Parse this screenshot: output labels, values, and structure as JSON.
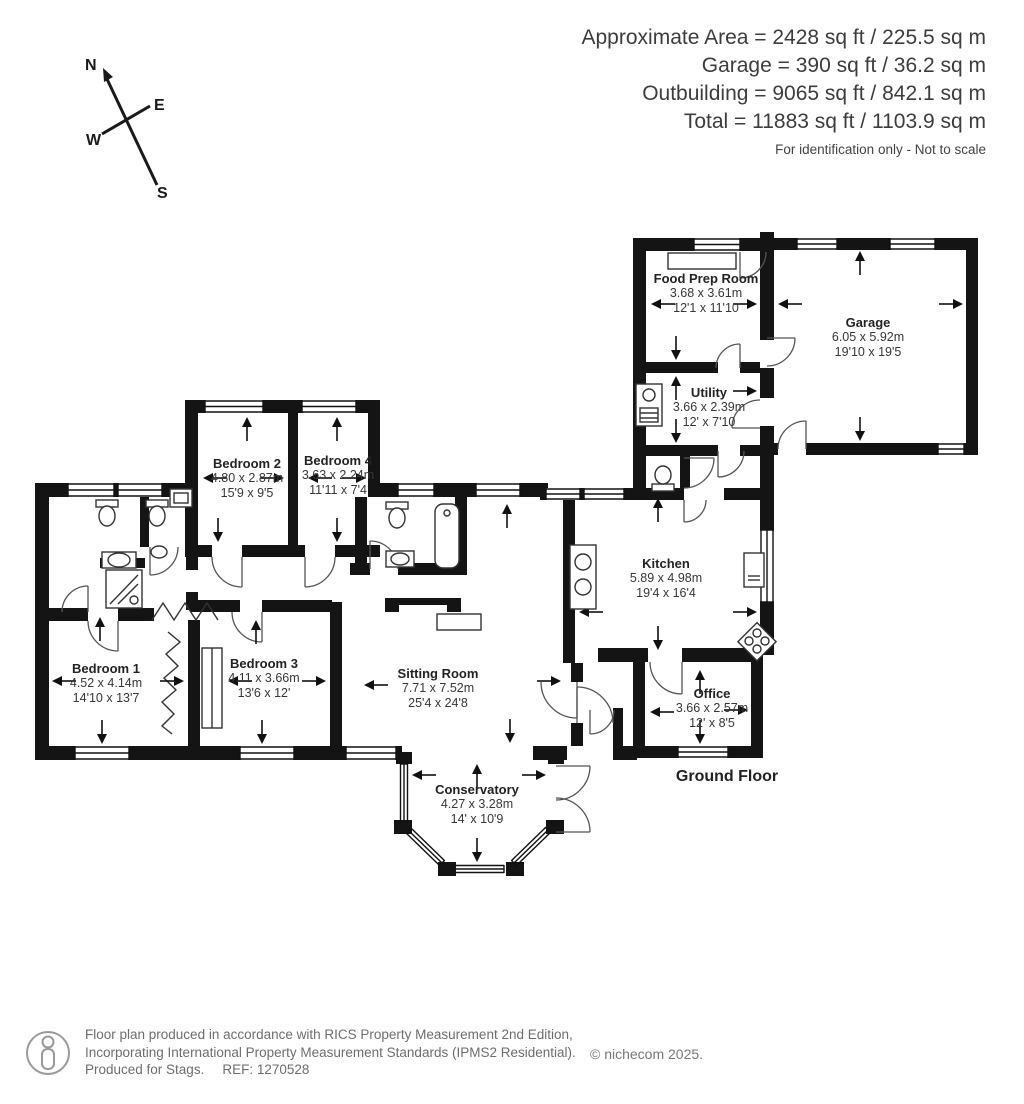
{
  "header": {
    "lines": [
      "Approximate Area = 2428 sq ft / 225.5 sq m",
      "Garage = 390 sq ft / 36.2 sq m",
      "Outbuilding = 9065 sq ft / 842.1 sq m",
      "Total = 11883 sq ft / 1103.9 sq m"
    ],
    "note": "For identification only - Not to scale"
  },
  "compass": {
    "n": "N",
    "e": "E",
    "w": "W",
    "s": "S"
  },
  "rooms": [
    {
      "id": "food-prep-room",
      "name": "Food Prep Room",
      "dim_m": "3.68 x 3.61m",
      "dim_ft": "12'1 x 11'10"
    },
    {
      "id": "garage",
      "name": "Garage",
      "dim_m": "6.05 x 5.92m",
      "dim_ft": "19'10 x 19'5"
    },
    {
      "id": "utility",
      "name": "Utility",
      "dim_m": "3.66 x 2.39m",
      "dim_ft": "12' x 7'10"
    },
    {
      "id": "kitchen",
      "name": "Kitchen",
      "dim_m": "5.89 x 4.98m",
      "dim_ft": "19'4 x 16'4"
    },
    {
      "id": "office",
      "name": "Office",
      "dim_m": "3.66 x 2.57m",
      "dim_ft": "12' x 8'5"
    },
    {
      "id": "bedroom-2",
      "name": "Bedroom 2",
      "dim_m": "4.80 x 2.87m",
      "dim_ft": "15'9 x 9'5"
    },
    {
      "id": "bedroom-4",
      "name": "Bedroom 4",
      "dim_m": "3.63 x 2.24m",
      "dim_ft": "11'11 x 7'4"
    },
    {
      "id": "bedroom-1",
      "name": "Bedroom 1",
      "dim_m": "4.52 x 4.14m",
      "dim_ft": "14'10 x 13'7"
    },
    {
      "id": "bedroom-3",
      "name": "Bedroom 3",
      "dim_m": "4.11 x 3.66m",
      "dim_ft": "13'6 x 12'"
    },
    {
      "id": "sitting-room",
      "name": "Sitting Room",
      "dim_m": "7.71 x 7.52m",
      "dim_ft": "25'4 x 24'8"
    },
    {
      "id": "conservatory",
      "name": "Conservatory",
      "dim_m": "4.27 x 3.28m",
      "dim_ft": "14' x 10'9"
    }
  ],
  "floor_label": "Ground Floor",
  "footer": {
    "line1": "Floor plan produced in accordance with RICS Property Measurement 2nd Edition,",
    "line2": "Incorporating International Property Measurement Standards (IPMS2 Residential).",
    "line3": "Produced for Stags.",
    "ref": "REF: 1270528",
    "copyright": "© nichecom 2025."
  },
  "colors": {
    "wall": "#141414",
    "line": "#555555",
    "text": "#3d3d3d"
  }
}
